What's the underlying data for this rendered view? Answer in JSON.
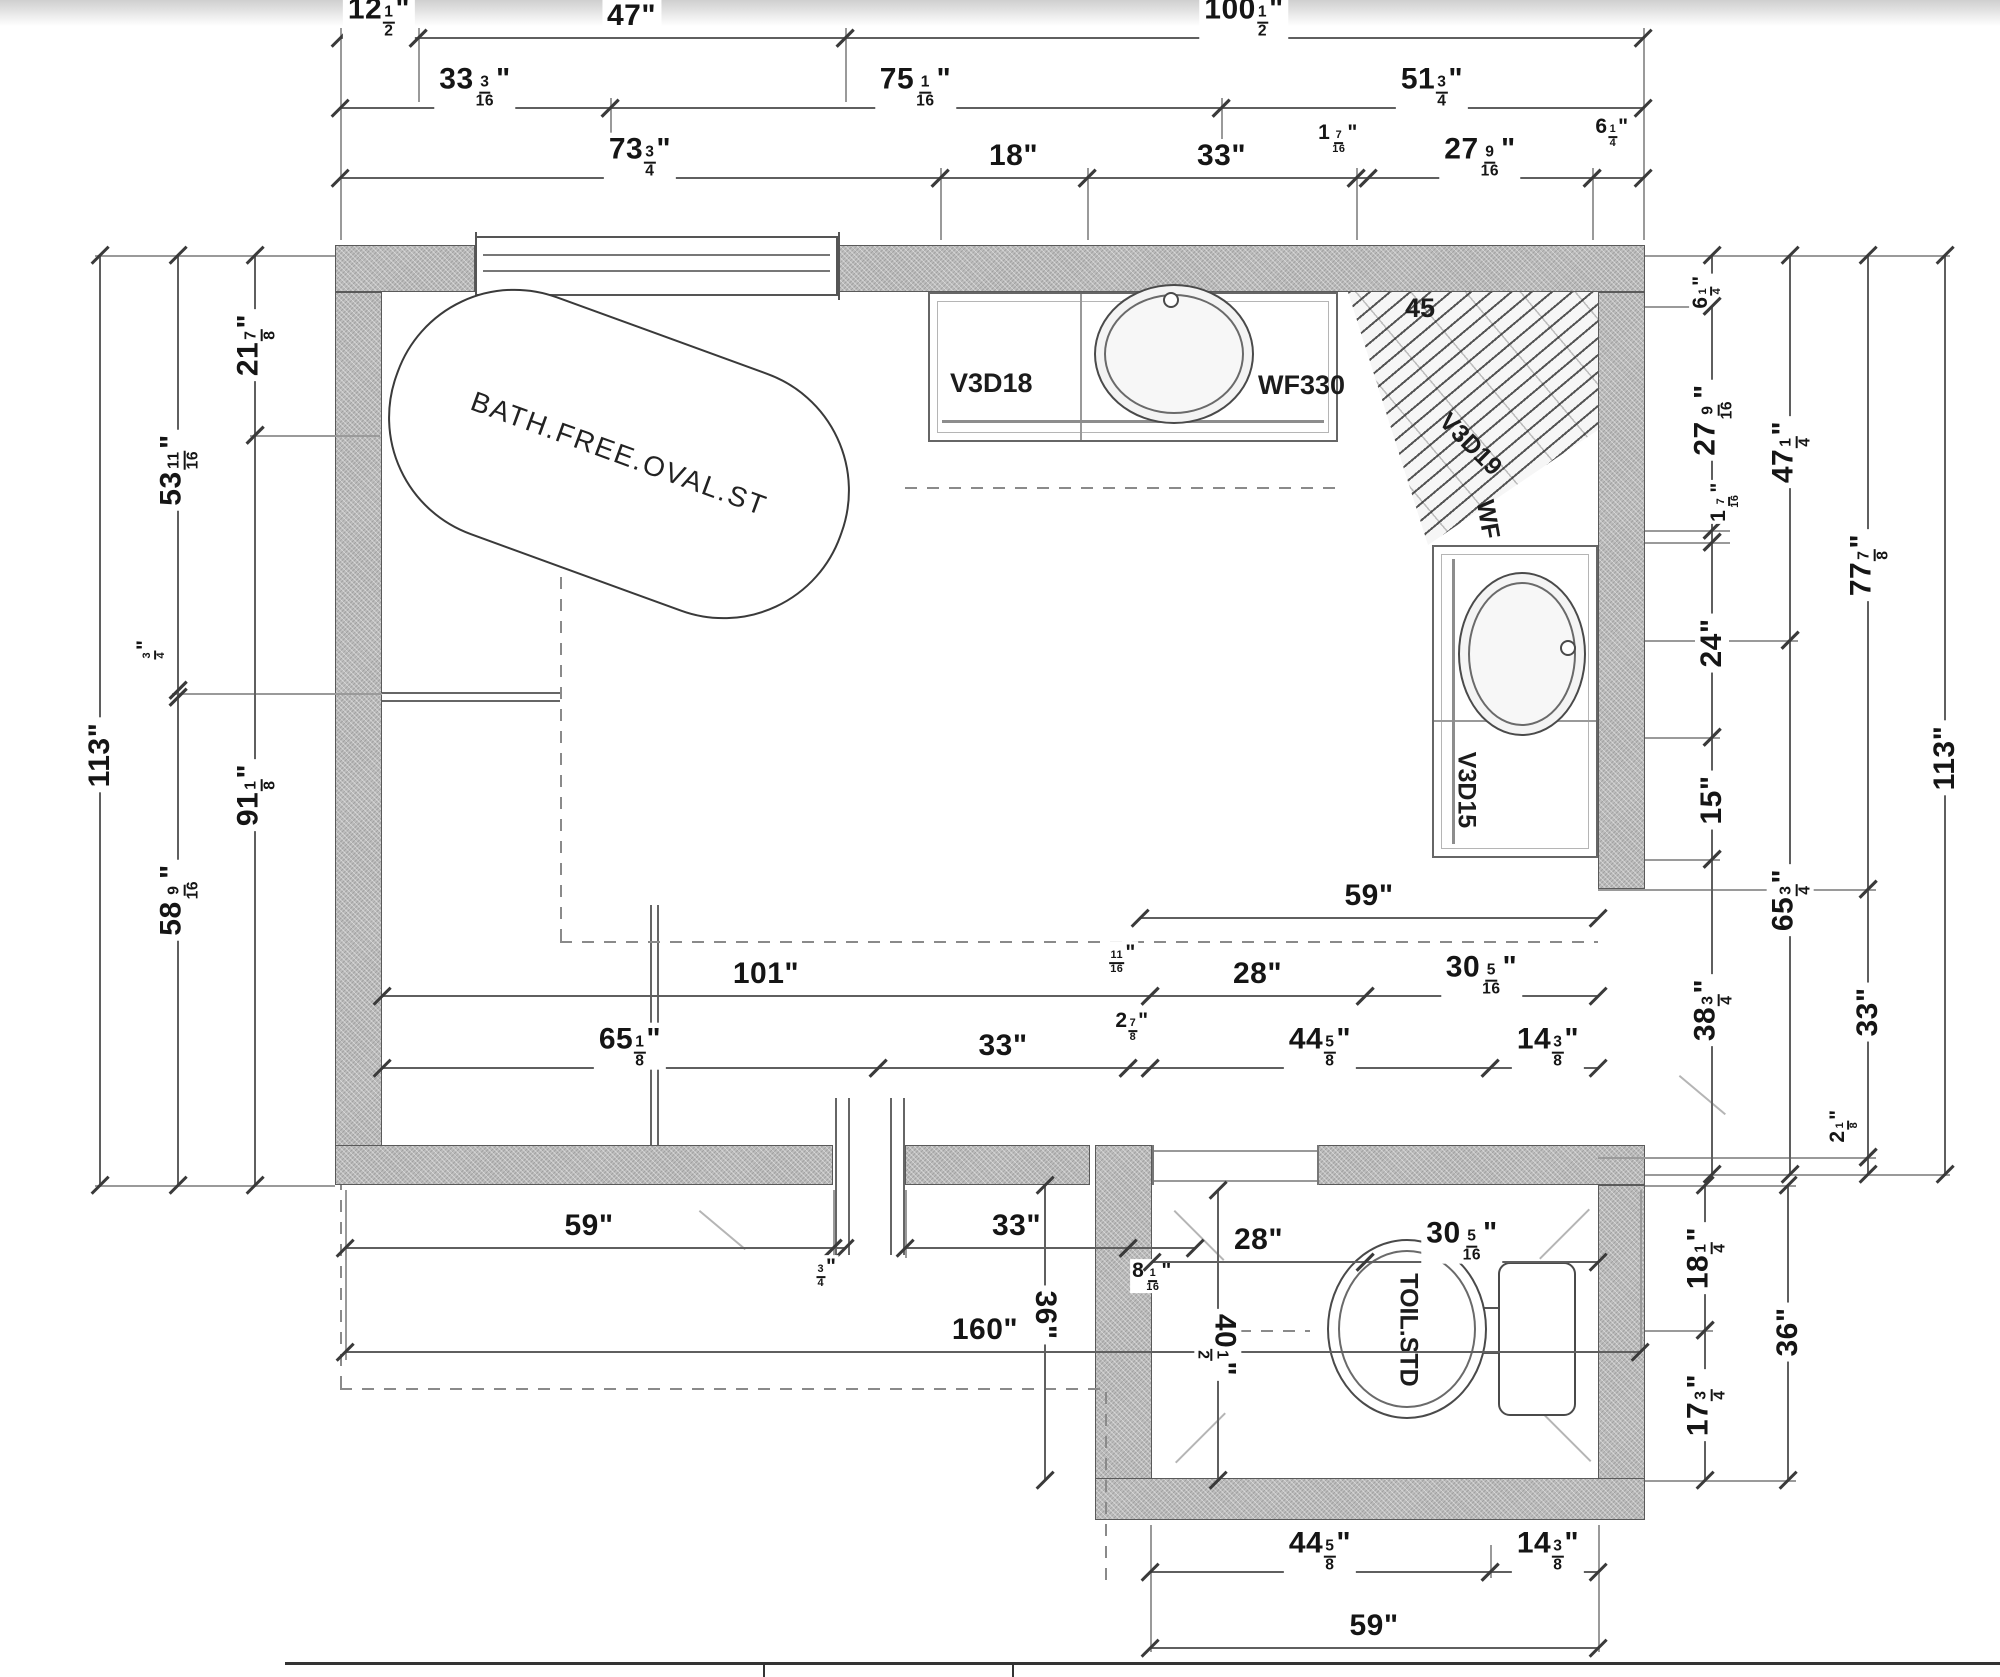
{
  "plan": {
    "labels": {
      "tub": "BATH.FREE.OVAL.ST",
      "vanity_top_left": "V3D18",
      "vanity_top_right": "WF330",
      "shower_angle": "45",
      "shower_unit": "V3D19",
      "shower_wf": "WF",
      "vanity_right": "V3D15",
      "toilet": "TOIL.STD"
    },
    "colors": {
      "wall_fill": "#bcbcbc",
      "line": "#5f5f5f",
      "dim_text": "#151515",
      "dash": "#8a8a8a"
    }
  },
  "dimensions": {
    "h": [
      {
        "t": "12 1/2\"",
        "x1": 340,
        "x2": 418,
        "y": 38,
        "ly": 16
      },
      {
        "t": "47\"",
        "x1": 418,
        "x2": 845,
        "y": 38,
        "ly": 16
      },
      {
        "t": "100 1/2\"",
        "x1": 845,
        "x2": 1643,
        "y": 38,
        "ly": 16
      },
      {
        "t": "33 3/16\"",
        "x1": 340,
        "x2": 610,
        "y": 108,
        "ly": 86
      },
      {
        "t": "75 1/16\"",
        "x1": 610,
        "x2": 1221,
        "y": 108,
        "ly": 86
      },
      {
        "t": "51 3/4\"",
        "x1": 1221,
        "x2": 1643,
        "y": 108,
        "ly": 86
      },
      {
        "t": "73 3/4\"",
        "x1": 340,
        "x2": 940,
        "y": 178,
        "ly": 156
      },
      {
        "t": "18\"",
        "x1": 940,
        "x2": 1087,
        "y": 178,
        "ly": 156
      },
      {
        "t": "33\"",
        "x1": 1087,
        "x2": 1356,
        "y": 178,
        "ly": 156
      },
      {
        "t": "1 7/16\"",
        "x1": 1356,
        "x2": 1368,
        "y": 178,
        "lx": 1338,
        "ly": 138,
        "s": 1
      },
      {
        "t": "27 9/16\"",
        "x1": 1368,
        "x2": 1592,
        "y": 178,
        "ly": 156
      },
      {
        "t": "6 1/4\"",
        "x1": 1592,
        "x2": 1643,
        "y": 178,
        "lx": 1612,
        "ly": 132,
        "s": 1
      },
      {
        "t": "59\"",
        "x1": 1140,
        "x2": 1598,
        "y": 918,
        "ly": 896
      },
      {
        "t": "101\"",
        "x1": 382,
        "x2": 1150,
        "y": 996,
        "ly": 974
      },
      {
        "t": "11/16\"",
        "x1": 1140,
        "x2": 1150,
        "y": 996,
        "lx": 1122,
        "ly": 958,
        "s": 1,
        "noline": 1
      },
      {
        "t": "28\"",
        "x1": 1150,
        "x2": 1365,
        "y": 996,
        "ly": 974
      },
      {
        "t": "30 5/16\"",
        "x1": 1365,
        "x2": 1598,
        "y": 996,
        "ly": 974
      },
      {
        "t": "65 1/8\"",
        "x1": 382,
        "x2": 878,
        "y": 1068,
        "ly": 1046
      },
      {
        "t": "33\"",
        "x1": 878,
        "x2": 1128,
        "y": 1068,
        "ly": 1046
      },
      {
        "t": "2 7/8\"",
        "x1": 1128,
        "x2": 1150,
        "y": 1068,
        "lx": 1132,
        "ly": 1026,
        "s": 1
      },
      {
        "t": "44 5/8\"",
        "x1": 1150,
        "x2": 1490,
        "y": 1068,
        "ly": 1046
      },
      {
        "t": "14 3/8\"",
        "x1": 1490,
        "x2": 1598,
        "y": 1068,
        "lx": 1548,
        "ly": 1046
      },
      {
        "t": "59\"",
        "x1": 345,
        "x2": 833,
        "y": 1248,
        "ly": 1226
      },
      {
        "t": "3/4\"",
        "x1": 833,
        "x2": 845,
        "y": 1248,
        "lx": 826,
        "ly": 1272,
        "s": 1
      },
      {
        "t": "33\"",
        "x1": 905,
        "x2": 1128,
        "y": 1248,
        "ly": 1226
      },
      {
        "t": "8 1/16\"",
        "x1": 1128,
        "x2": 1195,
        "y": 1248,
        "lx": 1152,
        "ly": 1276,
        "s": 1
      },
      {
        "t": "28\"",
        "x1": 1152,
        "x2": 1365,
        "y": 1262,
        "ly": 1240
      },
      {
        "t": "30 5/16\"",
        "x1": 1365,
        "x2": 1598,
        "y": 1262,
        "lx": 1462,
        "ly": 1240
      },
      {
        "t": "160\"",
        "x1": 345,
        "x2": 1640,
        "y": 1352,
        "lx": 985,
        "ly": 1330
      },
      {
        "t": "44 5/8\"",
        "x1": 1150,
        "x2": 1490,
        "y": 1572,
        "ly": 1550
      },
      {
        "t": "14 3/8\"",
        "x1": 1490,
        "x2": 1598,
        "y": 1572,
        "lx": 1548,
        "ly": 1550
      },
      {
        "t": "59\"",
        "x1": 1150,
        "x2": 1598,
        "y": 1648,
        "ly": 1626
      }
    ],
    "v": [
      {
        "t": "113\"",
        "x": 100,
        "y1": 255,
        "y2": 1185,
        "ly": 755
      },
      {
        "t": "53 11/16\"",
        "x": 178,
        "y1": 255,
        "y2": 690,
        "ly": 470
      },
      {
        "t": "3/4\"",
        "x": 178,
        "y1": 690,
        "y2": 697,
        "lx": 150,
        "ly": 650,
        "s": 1
      },
      {
        "t": "58 9/16\"",
        "x": 178,
        "y1": 697,
        "y2": 1185,
        "ly": 900
      },
      {
        "t": "21 7/8\"",
        "x": 255,
        "y1": 255,
        "y2": 435,
        "ly": 345
      },
      {
        "t": "91 1/8\"",
        "x": 255,
        "y1": 435,
        "y2": 1185,
        "ly": 795
      },
      {
        "t": "6 1/4\"",
        "x": 1712,
        "y1": 255,
        "y2": 306,
        "lx": 1706,
        "ly": 292,
        "s": 1
      },
      {
        "t": "27 9/16\"",
        "x": 1712,
        "y1": 306,
        "y2": 530,
        "ly": 420
      },
      {
        "t": "1 7/16\"",
        "x": 1712,
        "y1": 530,
        "y2": 542,
        "lx": 1724,
        "ly": 502,
        "s": 1
      },
      {
        "t": "24\"",
        "x": 1712,
        "y1": 542,
        "y2": 737,
        "ly": 643
      },
      {
        "t": "15\"",
        "x": 1712,
        "y1": 737,
        "y2": 859,
        "ly": 800
      },
      {
        "t": "38 3/4\"",
        "x": 1712,
        "y1": 859,
        "y2": 1174,
        "ly": 1010
      },
      {
        "t": "47 1/4\"",
        "x": 1790,
        "y1": 255,
        "y2": 640,
        "ly": 452
      },
      {
        "t": "65 3/4\"",
        "x": 1790,
        "y1": 640,
        "y2": 1174,
        "ly": 900
      },
      {
        "t": "77 7/8\"",
        "x": 1868,
        "y1": 255,
        "y2": 889,
        "ly": 565
      },
      {
        "t": "33\"",
        "x": 1868,
        "y1": 889,
        "y2": 1157,
        "ly": 1012
      },
      {
        "t": "2 1/8\"",
        "x": 1868,
        "y1": 1157,
        "y2": 1174,
        "lx": 1843,
        "ly": 1126,
        "s": 1
      },
      {
        "t": "113\"",
        "x": 1945,
        "y1": 255,
        "y2": 1174,
        "ly": 758
      },
      {
        "t": "18 1/4\"",
        "x": 1705,
        "y1": 1185,
        "y2": 1330,
        "ly": 1258
      },
      {
        "t": "17 3/4\"",
        "x": 1705,
        "y1": 1330,
        "y2": 1480,
        "ly": 1405
      },
      {
        "t": "36\"",
        "x": 1788,
        "y1": 1185,
        "y2": 1480,
        "ly": 1332
      },
      {
        "t": "36\"",
        "x": 1045,
        "y1": 1185,
        "y2": 1480,
        "ly": 1315,
        "rot": 90
      },
      {
        "t": "40 1/2\"",
        "x": 1218,
        "y1": 1190,
        "y2": 1480,
        "ly": 1345,
        "rot": 90
      }
    ]
  },
  "drawing": {
    "walls": [
      {
        "x": 335,
        "y": 245,
        "w": 140,
        "h": 47
      },
      {
        "x": 838,
        "y": 245,
        "w": 807,
        "h": 47
      },
      {
        "x": 335,
        "y": 292,
        "w": 47,
        "h": 893
      },
      {
        "x": 1598,
        "y": 292,
        "w": 47,
        "h": 597
      },
      {
        "x": 1598,
        "y": 1157,
        "w": 47,
        "h": 28
      },
      {
        "x": 1598,
        "y": 1185,
        "w": 47,
        "h": 335
      },
      {
        "x": 335,
        "y": 1145,
        "w": 498,
        "h": 40
      },
      {
        "x": 905,
        "y": 1145,
        "w": 185,
        "h": 40
      },
      {
        "x": 1095,
        "y": 1145,
        "w": 57,
        "h": 375
      },
      {
        "x": 1317,
        "y": 1145,
        "w": 328,
        "h": 40
      },
      {
        "x": 1095,
        "y": 1478,
        "w": 550,
        "h": 42
      }
    ],
    "guides": [
      {
        "o": "v",
        "x": 340,
        "y": 28,
        "l": 212
      },
      {
        "o": "v",
        "x": 418,
        "y": 28,
        "l": 74
      },
      {
        "o": "v",
        "x": 845,
        "y": 28,
        "l": 74
      },
      {
        "o": "v",
        "x": 1643,
        "y": 28,
        "l": 212
      },
      {
        "o": "v",
        "x": 610,
        "y": 98,
        "l": 74
      },
      {
        "o": "v",
        "x": 1221,
        "y": 98,
        "l": 74
      },
      {
        "o": "v",
        "x": 940,
        "y": 168,
        "l": 72
      },
      {
        "o": "v",
        "x": 1087,
        "y": 168,
        "l": 72
      },
      {
        "o": "v",
        "x": 1356,
        "y": 168,
        "l": 72
      },
      {
        "o": "v",
        "x": 1592,
        "y": 168,
        "l": 72
      },
      {
        "o": "h",
        "x": 95,
        "y": 255,
        "l": 240
      },
      {
        "o": "h",
        "x": 250,
        "y": 435,
        "l": 130
      },
      {
        "o": "h",
        "x": 172,
        "y": 693,
        "l": 210
      },
      {
        "o": "h",
        "x": 95,
        "y": 1185,
        "l": 240
      },
      {
        "o": "h",
        "x": 1645,
        "y": 255,
        "l": 305
      },
      {
        "o": "h",
        "x": 1645,
        "y": 306,
        "l": 75
      },
      {
        "o": "h",
        "x": 1645,
        "y": 530,
        "l": 85
      },
      {
        "o": "h",
        "x": 1645,
        "y": 542,
        "l": 85
      },
      {
        "o": "h",
        "x": 1645,
        "y": 640,
        "l": 153
      },
      {
        "o": "h",
        "x": 1645,
        "y": 737,
        "l": 75
      },
      {
        "o": "h",
        "x": 1645,
        "y": 859,
        "l": 75
      },
      {
        "o": "h",
        "x": 1598,
        "y": 889,
        "l": 278
      },
      {
        "o": "h",
        "x": 1598,
        "y": 1157,
        "l": 278
      },
      {
        "o": "h",
        "x": 1645,
        "y": 1174,
        "l": 305
      },
      {
        "o": "h",
        "x": 1645,
        "y": 1185,
        "l": 151
      },
      {
        "o": "h",
        "x": 1645,
        "y": 1330,
        "l": 68
      },
      {
        "o": "h",
        "x": 1645,
        "y": 1480,
        "l": 151
      },
      {
        "o": "v",
        "x": 345,
        "y": 1190,
        "l": 170
      },
      {
        "o": "v",
        "x": 833,
        "y": 1190,
        "l": 68
      },
      {
        "o": "v",
        "x": 905,
        "y": 1190,
        "l": 68
      },
      {
        "o": "v",
        "x": 1640,
        "y": 1190,
        "l": 162
      },
      {
        "o": "v",
        "x": 1150,
        "y": 1525,
        "l": 127
      },
      {
        "o": "v",
        "x": 1598,
        "y": 1525,
        "l": 127
      },
      {
        "o": "v",
        "x": 1490,
        "y": 1545,
        "l": 33
      },
      {
        "o": "v",
        "x": 835,
        "y": 1098,
        "l": 157,
        "c": "#666",
        "th": 2
      },
      {
        "o": "v",
        "x": 848,
        "y": 1098,
        "l": 157,
        "c": "#666",
        "th": 2
      },
      {
        "o": "v",
        "x": 890,
        "y": 1098,
        "l": 157,
        "c": "#666",
        "th": 2
      },
      {
        "o": "v",
        "x": 903,
        "y": 1098,
        "l": 157,
        "c": "#666",
        "th": 2
      },
      {
        "o": "h",
        "x": 382,
        "y": 692,
        "l": 178,
        "c": "#666",
        "th": 2
      },
      {
        "o": "h",
        "x": 382,
        "y": 700,
        "l": 178,
        "c": "#666",
        "th": 2
      },
      {
        "o": "v",
        "x": 650,
        "y": 905,
        "l": 240,
        "c": "#666",
        "th": 2
      },
      {
        "o": "v",
        "x": 657,
        "y": 905,
        "l": 240,
        "c": "#666",
        "th": 2
      },
      {
        "o": "h",
        "x": 1152,
        "y": 1150,
        "l": 165,
        "c": "#999"
      },
      {
        "o": "h",
        "x": 1152,
        "y": 1180,
        "l": 165,
        "c": "#999"
      },
      {
        "o": "v",
        "x": 1152,
        "y": 1145,
        "l": 40,
        "c": "#777",
        "th": 2
      },
      {
        "o": "v",
        "x": 1317,
        "y": 1145,
        "l": 40,
        "c": "#777",
        "th": 2
      },
      {
        "o": "h",
        "x": 1470,
        "y": 1307,
        "l": 32,
        "c": "#555",
        "th": 2
      },
      {
        "o": "h",
        "x": 1470,
        "y": 1352,
        "l": 32,
        "c": "#555",
        "th": 2
      },
      {
        "o": "v",
        "x": 475,
        "y": 232,
        "l": 68,
        "c": "#555",
        "th": 2
      },
      {
        "o": "v",
        "x": 838,
        "y": 232,
        "l": 68,
        "c": "#555",
        "th": 2
      },
      {
        "o": "h",
        "x": 285,
        "y": 1662,
        "l": 1715,
        "c": "#333",
        "th": 3
      },
      {
        "o": "v",
        "x": 763,
        "y": 1662,
        "l": 15,
        "c": "#333",
        "th": 2
      },
      {
        "o": "v",
        "x": 1012,
        "y": 1662,
        "l": 15,
        "c": "#333",
        "th": 2
      }
    ],
    "dashes": [
      {
        "o": "h",
        "x": 560,
        "y": 941,
        "l": 1038
      },
      {
        "o": "v",
        "x": 560,
        "y": 490,
        "l": 451
      },
      {
        "o": "h",
        "x": 905,
        "y": 487,
        "l": 440
      },
      {
        "o": "h",
        "x": 340,
        "y": 1388,
        "l": 765
      },
      {
        "o": "v",
        "x": 1105,
        "y": 1388,
        "l": 192
      },
      {
        "o": "v",
        "x": 340,
        "y": 1185,
        "l": 203
      },
      {
        "o": "h",
        "x": 1195,
        "y": 1330,
        "l": 115
      }
    ],
    "diags": [
      {
        "x": 1175,
        "y": 1210,
        "l": 70,
        "deg": 45
      },
      {
        "x": 1590,
        "y": 1210,
        "l": 70,
        "deg": 135
      },
      {
        "x": 1175,
        "y": 1462,
        "l": 70,
        "deg": -45
      },
      {
        "x": 1590,
        "y": 1462,
        "l": 70,
        "deg": -135
      },
      {
        "x": 1680,
        "y": 1075,
        "l": 60,
        "deg": 40
      },
      {
        "x": 700,
        "y": 1210,
        "l": 60,
        "deg": 40
      }
    ]
  }
}
